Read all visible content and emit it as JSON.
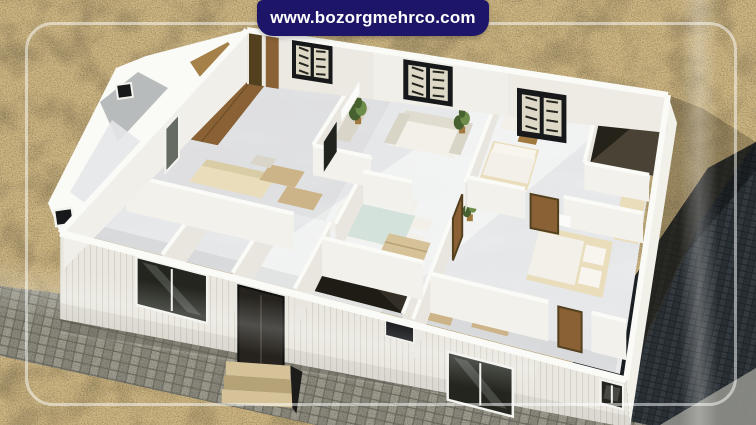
{
  "banner": {
    "url": "www.bozorgmehrco.com"
  },
  "palette": {
    "banner_bg": "#1d1668",
    "banner_text": "#ffffff",
    "frame": "rgba(255,255,255,0.5)",
    "sand": "#c9b17c",
    "sand_blotch": "#8f7a4e",
    "cobble_bg": "#716f64",
    "cobble_a": "#9d9b8d",
    "cobble_b": "#8b897c",
    "cobble_corner": "#8f9089",
    "paving_bg": "#1f2428",
    "paving_a": "#343b41",
    "paving_b": "#2b3237",
    "wall_top": "#fafaf7",
    "wall_front": "#e9e7df",
    "wall_rib": "#d6d3c9",
    "wall_right": "#f1f0e9",
    "wall_gray": "#a6abab",
    "wall_int_bright": "#f2f1ec",
    "wall_int_shade": "#e8e6df",
    "floor": "#e6e7e9",
    "floor_bright": "#f8f8f7",
    "dark_room": "#332f26",
    "dark_room_deep": "#1f1c15",
    "dark_room_warm": "#4a4234",
    "wood": "#8a6134",
    "wood_dark": "#53401f",
    "wood_mid": "#a0793f",
    "wood_plank": "#6e4f26",
    "step": "#d5c298",
    "step_shade": "#b5a276",
    "window_black": "#17181a",
    "glass": "#23251e",
    "pane": "#ded9c6",
    "frame_white": "#f2f2ee",
    "furn_white": "#f2f0e8",
    "furn_cream": "#e9ddbc",
    "furn_tan": "#cdb488",
    "furn_gray": "#d9d5c8",
    "plant_dark": "#46602f",
    "plant_light": "#6e8c49",
    "tv": "#20231e",
    "mirror": "#666b64",
    "glass_table": "#cfe0d8",
    "ac": "#fbfbf9",
    "shadow": "rgba(58,50,32,0.32)",
    "shadow_paving": "rgba(8,10,14,0.45)",
    "wall_shadow": "rgba(60,58,48,0.28)"
  }
}
